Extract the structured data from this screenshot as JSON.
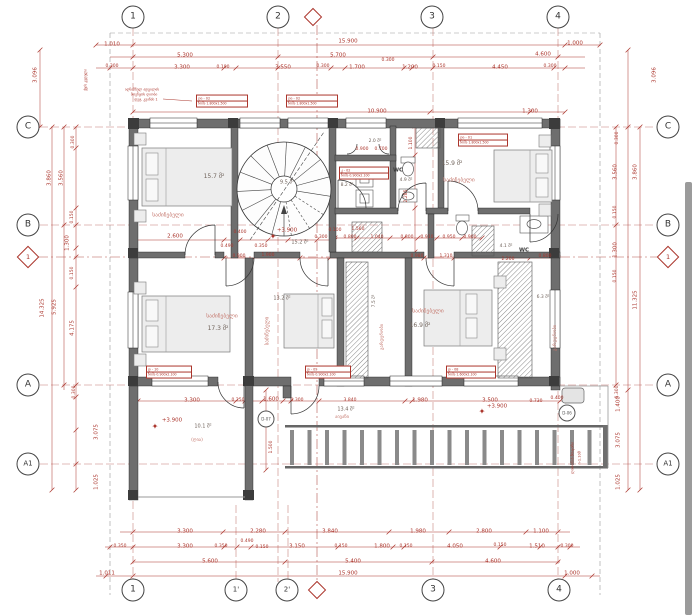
{
  "meta": {
    "drawing_type": "architectural floor plan",
    "language": "Georgian",
    "level_mark": "+3.900"
  },
  "colors": {
    "dim": "#ab352c",
    "name": "#c4756b",
    "area": "#70635b",
    "dark": "#3c3c3c",
    "grid": "#b5564e"
  },
  "grid": {
    "top": [
      {
        "label": "1",
        "x": 133,
        "y": 17
      },
      {
        "label": "2",
        "x": 278,
        "y": 17
      },
      {
        "label": "3",
        "x": 432,
        "y": 17
      },
      {
        "label": "4",
        "x": 558,
        "y": 17
      }
    ],
    "bottom": [
      {
        "label": "1",
        "x": 133,
        "y": 590
      },
      {
        "label": "1'",
        "x": 236,
        "y": 590
      },
      {
        "label": "2'",
        "x": 287,
        "y": 590
      },
      {
        "label": "3",
        "x": 433,
        "y": 590
      },
      {
        "label": "4",
        "x": 559,
        "y": 590
      }
    ],
    "left": [
      {
        "label": "C",
        "x": 28,
        "y": 127
      },
      {
        "label": "B",
        "x": 28,
        "y": 225
      },
      {
        "label": "A",
        "x": 28,
        "y": 385
      },
      {
        "label": "A1",
        "x": 28,
        "y": 464
      }
    ],
    "right": [
      {
        "label": "C",
        "x": 668,
        "y": 127
      },
      {
        "label": "B",
        "x": 668,
        "y": 225
      },
      {
        "label": "A",
        "x": 668,
        "y": 385
      },
      {
        "label": "A1",
        "x": 668,
        "y": 464
      }
    ],
    "diamonds": [
      {
        "label": "",
        "x": 313,
        "y": 17,
        "s": 11
      },
      {
        "label": "",
        "x": 317,
        "y": 590,
        "s": 11
      },
      {
        "label": "1",
        "x": 28,
        "y": 257,
        "s": 14
      },
      {
        "label": "1",
        "x": 668,
        "y": 257,
        "s": 14
      }
    ]
  },
  "labels": [
    [
      "1.010",
      112,
      45
    ],
    [
      "15.900",
      348,
      42
    ],
    [
      "1.000",
      575,
      44
    ],
    [
      "5.300",
      185,
      56
    ],
    [
      "5.700",
      338,
      56
    ],
    [
      "4.600",
      543,
      55
    ],
    [
      "0.300",
      388,
      61,
      0,
      4.5
    ],
    [
      "0.300",
      112,
      67,
      0,
      4.5
    ],
    [
      "3.300",
      182,
      68
    ],
    [
      "0.190",
      223,
      68,
      0,
      4.5
    ],
    [
      "3.550",
      283,
      68
    ],
    [
      "0.300",
      323,
      67,
      0,
      4.5
    ],
    [
      "1.700",
      357,
      68
    ],
    [
      "1.200",
      410,
      68
    ],
    [
      "0.150",
      439,
      67,
      0,
      4.5
    ],
    [
      "4.450",
      500,
      68
    ],
    [
      "0.300",
      550,
      67,
      0,
      4.5
    ],
    [
      "10.900",
      377,
      112
    ],
    [
      "1.300",
      530,
      112
    ],
    [
      "3.096",
      36,
      75,
      -90
    ],
    [
      "0.300",
      74,
      142,
      -90,
      4.5
    ],
    [
      "3.860",
      50,
      178,
      -90
    ],
    [
      "3.560",
      62,
      178,
      -90
    ],
    [
      "0.150",
      73,
      217,
      -90,
      4.5
    ],
    [
      "1.300",
      68,
      243,
      -90
    ],
    [
      "0.150",
      73,
      273,
      -90,
      4.5
    ],
    [
      "14.325",
      43,
      308,
      -90
    ],
    [
      "5.925",
      55,
      307,
      -90
    ],
    [
      "4.175",
      73,
      328,
      -90
    ],
    [
      "0.300",
      75,
      392,
      -90,
      4.5
    ],
    [
      "3.075",
      97,
      432,
      -90
    ],
    [
      "1.025",
      97,
      482,
      -90
    ],
    [
      "3.096",
      655,
      75,
      -90
    ],
    [
      "0.300",
      618,
      138,
      -90,
      4.5
    ],
    [
      "3.560",
      616,
      172,
      -90
    ],
    [
      "3.860",
      636,
      172,
      -90
    ],
    [
      "0.150",
      616,
      212,
      -90,
      4.5
    ],
    [
      "1.300",
      616,
      250,
      -90
    ],
    [
      "0.150",
      616,
      276,
      -90,
      4.5
    ],
    [
      "11.325",
      636,
      300,
      -90
    ],
    [
      "0.300",
      618,
      392,
      -90,
      4.5
    ],
    [
      "1.400",
      619,
      404,
      -90
    ],
    [
      "3.075",
      619,
      440,
      -90
    ],
    [
      "1.025",
      619,
      482,
      -90
    ],
    [
      "3.300",
      185,
      532
    ],
    [
      "2.280",
      258,
      532
    ],
    [
      "3.840",
      330,
      532
    ],
    [
      "1.980",
      418,
      532
    ],
    [
      "2.800",
      484,
      532
    ],
    [
      "1.100",
      541,
      532
    ],
    [
      "0.350",
      120,
      547,
      0,
      4.5
    ],
    [
      "3.300",
      185,
      547
    ],
    [
      "0.350",
      221,
      547,
      0,
      4.5
    ],
    [
      "0.490",
      247,
      542,
      0,
      4.5
    ],
    [
      "0.150",
      262,
      548,
      0,
      4.5
    ],
    [
      "3.150",
      297,
      547
    ],
    [
      "0.150",
      341,
      547,
      0,
      4.5
    ],
    [
      "1.800",
      382,
      547
    ],
    [
      "0.150",
      406,
      547,
      0,
      4.5
    ],
    [
      "4.050",
      455,
      547
    ],
    [
      "0.150",
      500,
      546,
      0,
      4.5
    ],
    [
      "1.510",
      537,
      547
    ],
    [
      "0.300",
      567,
      547,
      0,
      4.5
    ],
    [
      "5.600",
      210,
      562
    ],
    [
      "5.400",
      353,
      562
    ],
    [
      "4.600",
      493,
      562
    ],
    [
      "1.011",
      107,
      574
    ],
    [
      "15.900",
      348,
      574
    ],
    [
      "1.000",
      572,
      574
    ],
    [
      "2.600",
      175,
      237
    ],
    [
      "0.400",
      240,
      233,
      0,
      4.5
    ],
    [
      "0.490",
      227,
      247,
      0,
      4.5
    ],
    [
      "0.350",
      261,
      247,
      0,
      4.5
    ],
    [
      "0.100",
      335,
      231,
      0,
      4.5
    ],
    [
      "0.300",
      321,
      238,
      0,
      4.5
    ],
    [
      "0.800",
      350,
      238,
      0,
      4.5
    ],
    [
      "1.040",
      377,
      238,
      0,
      4.5
    ],
    [
      "0.800",
      407,
      238,
      0,
      4.5
    ],
    [
      "0.910",
      427,
      238,
      0,
      4.5
    ],
    [
      "0.950",
      449,
      238,
      0,
      4.5
    ],
    [
      "0.900",
      470,
      238,
      0,
      4.5
    ],
    [
      "0.900",
      239,
      257,
      0,
      4.5
    ],
    [
      "1.900",
      268,
      256,
      0,
      4.5
    ],
    [
      "0.980",
      417,
      257,
      0,
      4.5
    ],
    [
      "1.310",
      446,
      257,
      0,
      4.5
    ],
    [
      "2.200",
      508,
      260,
      0,
      4.5
    ],
    [
      "0.800",
      545,
      257,
      0,
      4.5
    ],
    [
      "0.900",
      362,
      150,
      0,
      4.5
    ],
    [
      "0.700",
      381,
      150,
      0,
      4.5
    ],
    [
      "1.100",
      412,
      143,
      -90,
      4.5
    ],
    [
      "2.285",
      407,
      196,
      -90,
      4.5
    ],
    [
      "1.560",
      358,
      230,
      0,
      4.5
    ],
    [
      "3.300",
      192,
      401
    ],
    [
      "0.250",
      238,
      401,
      0,
      4.5
    ],
    [
      "1.600",
      271,
      400
    ],
    [
      "0.300",
      297,
      401,
      0,
      4.5
    ],
    [
      "3.840",
      350,
      401,
      0,
      4.5
    ],
    [
      "1.980",
      420,
      401
    ],
    [
      "3.500",
      490,
      401
    ],
    [
      "0.730",
      536,
      402,
      0,
      4.5
    ],
    [
      "0.400",
      557,
      399,
      0,
      4.5
    ],
    [
      "1.500",
      272,
      447,
      -90,
      4.5
    ],
    [
      "+3.900",
      287,
      231
    ],
    [
      "+3.900",
      172,
      421
    ],
    [
      "+3.900",
      497,
      407
    ],
    [
      "✦",
      273,
      237,
      0,
      8
    ],
    [
      "✦",
      155,
      427,
      0,
      8
    ],
    [
      "✦",
      482,
      412,
      0,
      8
    ],
    [
      "15.7 მ²",
      214,
      177,
      0,
      6,
      "area"
    ],
    [
      "საძინებელი",
      168,
      216,
      0,
      5.5,
      "name"
    ],
    [
      "9.5 მ²",
      287,
      183,
      0,
      5,
      "area"
    ],
    [
      "15.9 მ²",
      452,
      164,
      0,
      6,
      "area"
    ],
    [
      "საძინებელი",
      459,
      181,
      0,
      5.5,
      "name"
    ],
    [
      "2.0 მ²",
      375,
      142,
      0,
      4.5,
      "area"
    ],
    [
      "8.2 მ²",
      347,
      186,
      0,
      4.5,
      "area"
    ],
    [
      "4.9 მ²",
      406,
      181,
      0,
      4.5,
      "area"
    ],
    [
      "WC",
      398,
      171,
      0,
      5.5,
      "dark",
      1
    ],
    [
      "15.2 მ²",
      300,
      243,
      0,
      5,
      "area"
    ],
    [
      "4.1 მ²",
      506,
      247,
      0,
      4.5,
      "area"
    ],
    [
      "WC",
      524,
      251,
      0,
      5.5,
      "dark",
      1
    ],
    [
      "17.3 მ²",
      218,
      329,
      0,
      6,
      "area"
    ],
    [
      "საძინებელი",
      222,
      317,
      0,
      5.5,
      "name"
    ],
    [
      "13.2 მ²",
      282,
      299,
      0,
      5,
      "area"
    ],
    [
      "საძინებელი",
      268,
      331,
      -90,
      5,
      "name"
    ],
    [
      "16.9 მ²",
      420,
      326,
      0,
      6,
      "area"
    ],
    [
      "საძინებელი",
      428,
      312,
      0,
      5.5,
      "name"
    ],
    [
      "7.5 მ²",
      375,
      301,
      -90,
      4.5,
      "area"
    ],
    [
      "გარდერობი",
      383,
      337,
      -90,
      4.5,
      "name"
    ],
    [
      "6.3 მ²",
      543,
      298,
      0,
      4.5,
      "area"
    ],
    [
      "გარდერობი",
      556,
      338,
      -90,
      4.5,
      "name"
    ],
    [
      "10.1 მ²",
      203,
      427,
      0,
      5,
      "area"
    ],
    [
      "(ღია)",
      197,
      441,
      0,
      4.5,
      "name"
    ],
    [
      "13.4 მ²",
      346,
      410,
      0,
      5,
      "area"
    ],
    [
      "აივანი",
      342,
      418,
      0,
      4.5,
      "name"
    ],
    [
      "აღნიშნულ ადგილას",
      142,
      90,
      0,
      3.5
    ],
    [
      "მოეწყოს ღიობი",
      144,
      95,
      0,
      3.5
    ],
    [
      "დეტ. კვანძი 1",
      146,
      100,
      0,
      3.5
    ],
    [
      "ქვის კედელი",
      86,
      80,
      -90,
      3.5
    ],
    [
      "ლითონის მოაჯირი",
      573,
      458,
      -90,
      3.5
    ],
    [
      "h-1.10მ",
      580,
      458,
      -90,
      3.5
    ]
  ],
  "tags": [
    {
      "l1": "ღი - 02",
      "l2": "ზომა 1.800x1.500",
      "x": 196,
      "y": 101,
      "w": 50
    },
    {
      "l1": "ღი - 02",
      "l2": "ზომა 1.800x1.500",
      "x": 286,
      "y": 101,
      "w": 50
    },
    {
      "l1": "კ - 02",
      "l2": "ზომა 0.900x2.100",
      "x": 339,
      "y": 173,
      "w": 48
    },
    {
      "l1": "ღი - 01",
      "l2": "ზომა 1.800x1.500",
      "x": 458,
      "y": 140,
      "w": 48
    },
    {
      "l1": "დ - 10",
      "l2": "ზომა 0.900x2.100",
      "x": 146,
      "y": 372,
      "w": 44
    },
    {
      "l1": "დ - 09",
      "l2": "ზომა 0.900x2.100",
      "x": 305,
      "y": 372,
      "w": 44
    },
    {
      "l1": "დ - 08",
      "l2": "ზომა 1.600x2.100",
      "x": 446,
      "y": 372,
      "w": 48
    }
  ],
  "detail_circles": [
    {
      "label": "D-07",
      "x": 266,
      "y": 419
    },
    {
      "label": "D-06",
      "x": 567,
      "y": 413
    }
  ],
  "dimlines": {
    "h": [
      {
        "y": 45,
        "x1": 96,
        "x2": 600,
        "t": [
          96,
          133,
          565,
          600
        ]
      },
      {
        "y": 57,
        "x1": 110,
        "x2": 585,
        "t": [
          133,
          278,
          433,
          558
        ]
      },
      {
        "y": 68,
        "x1": 96,
        "x2": 585,
        "t": [
          110,
          133,
          224,
          236,
          278,
          331,
          345,
          404,
          412,
          433,
          554,
          565
        ]
      },
      {
        "y": 112,
        "x1": 133,
        "x2": 565,
        "t": [
          133,
          430,
          530,
          565
        ]
      },
      {
        "y": 240,
        "x1": 133,
        "x2": 335,
        "t": [
          133,
          224,
          240,
          268,
          288,
          317,
          335
        ]
      },
      {
        "y": 238,
        "x1": 335,
        "x2": 482,
        "t": [
          335,
          357,
          390,
          404,
          418,
          437,
          462,
          482
        ]
      },
      {
        "y": 258,
        "x1": 224,
        "x2": 560,
        "t": [
          224,
          254,
          300,
          330,
          424,
          454,
          530,
          558
        ]
      },
      {
        "y": 401,
        "x1": 138,
        "x2": 570,
        "t": [
          138,
          236,
          245,
          262,
          283,
          291,
          319,
          405,
          412,
          560,
          568
        ]
      },
      {
        "y": 532,
        "x1": 120,
        "x2": 570,
        "t": [
          133,
          223,
          285,
          389,
          449,
          526,
          558
        ]
      },
      {
        "y": 547,
        "x1": 105,
        "x2": 580,
        "t": [
          110,
          133,
          224,
          237,
          251,
          338,
          393,
          404,
          500,
          540,
          558,
          570
        ]
      },
      {
        "y": 562,
        "x1": 133,
        "x2": 560,
        "t": [
          133,
          285,
          432,
          558
        ]
      },
      {
        "y": 576,
        "x1": 96,
        "x2": 600,
        "t": [
          106,
          133,
          565,
          592
        ]
      }
    ],
    "v": [
      {
        "x": 40,
        "y1": 50,
        "y2": 127,
        "t": [
          50,
          127
        ]
      },
      {
        "x": 52,
        "y1": 127,
        "y2": 490,
        "t": [
          127,
          490
        ]
      },
      {
        "x": 64,
        "y1": 127,
        "y2": 390,
        "t": [
          127,
          225,
          385
        ]
      },
      {
        "x": 76,
        "y1": 127,
        "y2": 490,
        "t": [
          127,
          148,
          208,
          225,
          248,
          257,
          287,
          385,
          397,
          430,
          464,
          490
        ]
      },
      {
        "x": 616,
        "y1": 127,
        "y2": 385,
        "t": [
          127,
          225,
          385
        ]
      },
      {
        "x": 628,
        "y1": 50,
        "y2": 490,
        "t": [
          50,
          127,
          390,
          490
        ]
      },
      {
        "x": 640,
        "y1": 127,
        "y2": 490,
        "t": [
          127,
          490
        ]
      },
      {
        "x": 415,
        "y1": 126,
        "y2": 252,
        "t": [
          126,
          155,
          208,
          252
        ]
      },
      {
        "x": 266,
        "y1": 390,
        "y2": 470,
        "t": [
          390,
          414,
          470
        ]
      }
    ]
  },
  "gridlines": {
    "v_main": [
      133,
      278,
      433,
      558
    ],
    "v_section": 317,
    "v_short": [
      236,
      288
    ],
    "h_main": [
      127,
      225,
      385,
      464
    ],
    "h_section": 257
  },
  "scrollbar": {
    "x": 685,
    "y": 182,
    "w": 7,
    "h": 433
  }
}
